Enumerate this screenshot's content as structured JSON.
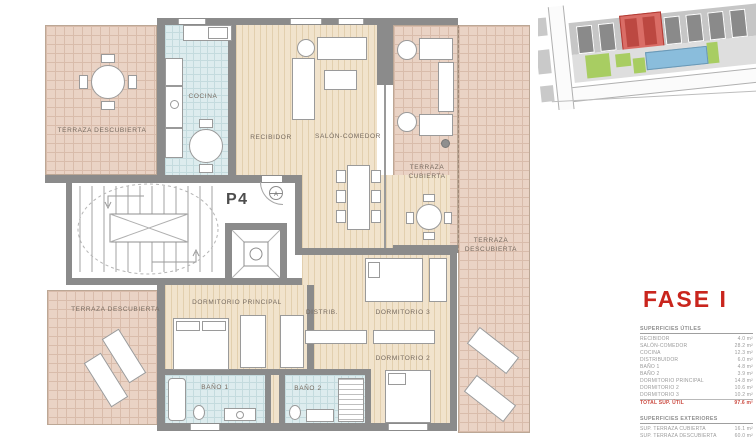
{
  "colors": {
    "accent_red": "#c9251d",
    "terrace_fill": "#ead3c5",
    "wood_fill": "#f1e3cc",
    "tile_fill": "#ddecee",
    "wall_gray": "#8b8b8b",
    "label_gray": "#75695e"
  },
  "plan": {
    "unit_label": "P4",
    "section_marker": "A",
    "labels": {
      "terraza_top_left": "TERRAZA DESCUBIERTA",
      "cocina": "COCINA",
      "recibidor": "RECIBIDOR",
      "salon_comedor": "SALÓN-COMEDOR",
      "terraza_cubierta": "TERRAZA CUBIERTA",
      "terraza_right": "TERRAZA DESCUBIERTA",
      "terraza_bottom_left": "TERRAZA DESCUBIERTA",
      "dormitorio_principal": "DORMITORIO PRINCIPAL",
      "distribuidor": "DISTRIB.",
      "dormitorio_3": "DORMITORIO 3",
      "dormitorio_2": "DORMITORIO 2",
      "bano_1": "BAÑO 1",
      "bano_2": "BAÑO 2"
    }
  },
  "sidebar": {
    "phase_title": "FASE I",
    "superficies_utiles": {
      "title": "SUPERFICIES ÚTILES",
      "rows": [
        {
          "label": "RECIBIDOR",
          "value": "4.0 m²"
        },
        {
          "label": "SALÓN-COMEDOR",
          "value": "28.2 m²"
        },
        {
          "label": "COCINA",
          "value": "12.3 m²"
        },
        {
          "label": "DISTRIBUIDOR",
          "value": "6.0 m²"
        },
        {
          "label": "BAÑO 1",
          "value": "4.8 m²"
        },
        {
          "label": "BAÑO 2",
          "value": "3.9 m²"
        },
        {
          "label": "DORMITORIO PRINCIPAL",
          "value": "14.8 m²"
        },
        {
          "label": "DORMITORIO 2",
          "value": "10.6 m²"
        },
        {
          "label": "DORMITORIO 3",
          "value": "10.2 m²"
        }
      ],
      "total": {
        "label": "TOTAL SUP. ÚTIL",
        "value": "97.6 m²"
      }
    },
    "superficies_exteriores": {
      "title": "SUPERFICIES EXTERIORES",
      "rows": [
        {
          "label": "SUP. TERRAZA CUBIERTA",
          "value": "16.1 m²"
        },
        {
          "label": "SUP. TERRAZA DESCUBIERTA",
          "value": "60.0 m²"
        }
      ]
    },
    "grand_total": {
      "label": "TOTAL SUP. CONST. + TZ.CC.",
      "value": "153.80 m²"
    }
  }
}
